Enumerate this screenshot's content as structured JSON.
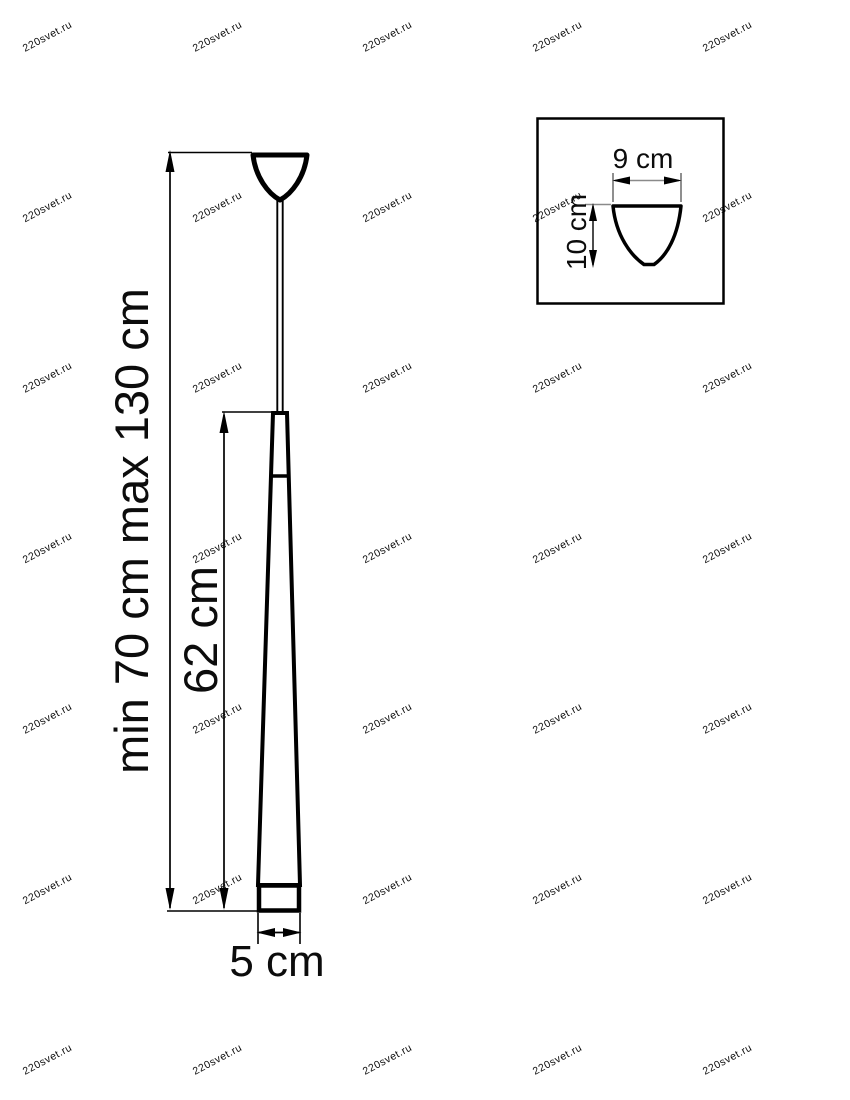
{
  "main": {
    "suspension_label": "min 70 cm  max 130 cm",
    "shade_height_label": "62 cm",
    "shade_width_label": "5 cm"
  },
  "detail": {
    "width_label": "9 cm",
    "height_label": "10 cm"
  },
  "watermark": {
    "text": "220svet.ru",
    "color": "#c4c4c4"
  },
  "colors": {
    "line": "#000000",
    "detail_dim_line": "#8a8a8a"
  }
}
